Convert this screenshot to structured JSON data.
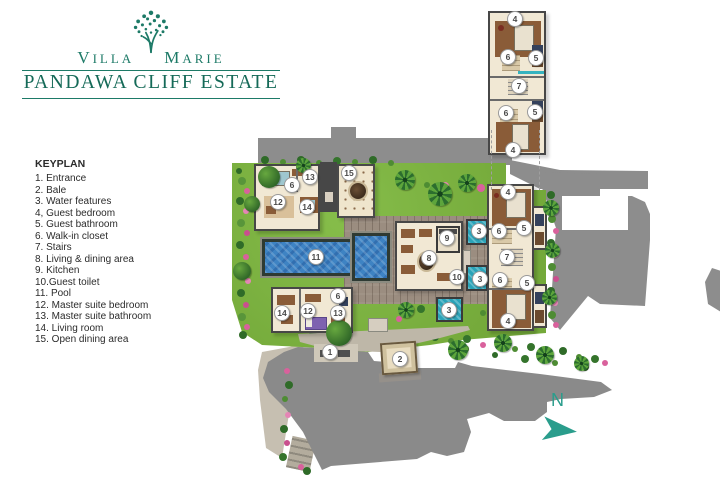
{
  "logo": {
    "title_word1": "Villa",
    "title_word2": "Marie",
    "subtitle": "PANDAWA CLIFF ESTATE"
  },
  "legend": {
    "title": "KEYPLAN",
    "items": [
      "1. Entrance",
      "2. Bale",
      "3. Water features",
      "4, Guest bedroom",
      "5. Guest bathroom",
      "6. Walk-in closet",
      "7. Stairs",
      "8. Living & dining area",
      "9. Kitchen",
      "10.Guest toilet",
      "11. Pool",
      "12. Master suite bedroom",
      "13. Master suite bathroom",
      "14. Living room",
      "15. Open dining area"
    ]
  },
  "compass": {
    "north_label": "N"
  },
  "colors": {
    "brand_teal": "#1d7a67",
    "compass_teal": "#2a9d8c",
    "pool_blue": "#3e83c3",
    "water_feature_teal": "#2aa3b8",
    "road_gray": "#8d8d8d",
    "lawn_green": "#74a93a"
  },
  "plan": {
    "markers": [
      {
        "n": "1",
        "x": 330,
        "y": 352
      },
      {
        "n": "2",
        "x": 400,
        "y": 359
      },
      {
        "n": "3",
        "x": 479,
        "y": 231
      },
      {
        "n": "3",
        "x": 480,
        "y": 279
      },
      {
        "n": "3",
        "x": 449,
        "y": 310
      },
      {
        "n": "4",
        "x": 508,
        "y": 192
      },
      {
        "n": "4",
        "x": 508,
        "y": 321
      },
      {
        "n": "5",
        "x": 524,
        "y": 228
      },
      {
        "n": "5",
        "x": 527,
        "y": 283
      },
      {
        "n": "6",
        "x": 292,
        "y": 185
      },
      {
        "n": "6",
        "x": 338,
        "y": 296
      },
      {
        "n": "6",
        "x": 499,
        "y": 231
      },
      {
        "n": "6",
        "x": 500,
        "y": 280
      },
      {
        "n": "7",
        "x": 507,
        "y": 257
      },
      {
        "n": "8",
        "x": 429,
        "y": 258
      },
      {
        "n": "9",
        "x": 447,
        "y": 238
      },
      {
        "n": "10",
        "x": 457,
        "y": 277
      },
      {
        "n": "11",
        "x": 316,
        "y": 257
      },
      {
        "n": "12",
        "x": 278,
        "y": 202
      },
      {
        "n": "12",
        "x": 308,
        "y": 311
      },
      {
        "n": "13",
        "x": 310,
        "y": 177
      },
      {
        "n": "13",
        "x": 338,
        "y": 313
      },
      {
        "n": "14",
        "x": 307,
        "y": 207
      },
      {
        "n": "14",
        "x": 282,
        "y": 313
      },
      {
        "n": "15",
        "x": 349,
        "y": 173
      },
      {
        "n": "4",
        "x": 515,
        "y": 19
      },
      {
        "n": "6",
        "x": 508,
        "y": 57
      },
      {
        "n": "5",
        "x": 536,
        "y": 58
      },
      {
        "n": "7",
        "x": 519,
        "y": 86
      },
      {
        "n": "6",
        "x": 506,
        "y": 113
      },
      {
        "n": "5",
        "x": 535,
        "y": 112
      },
      {
        "n": "4",
        "x": 513,
        "y": 150
      }
    ]
  }
}
